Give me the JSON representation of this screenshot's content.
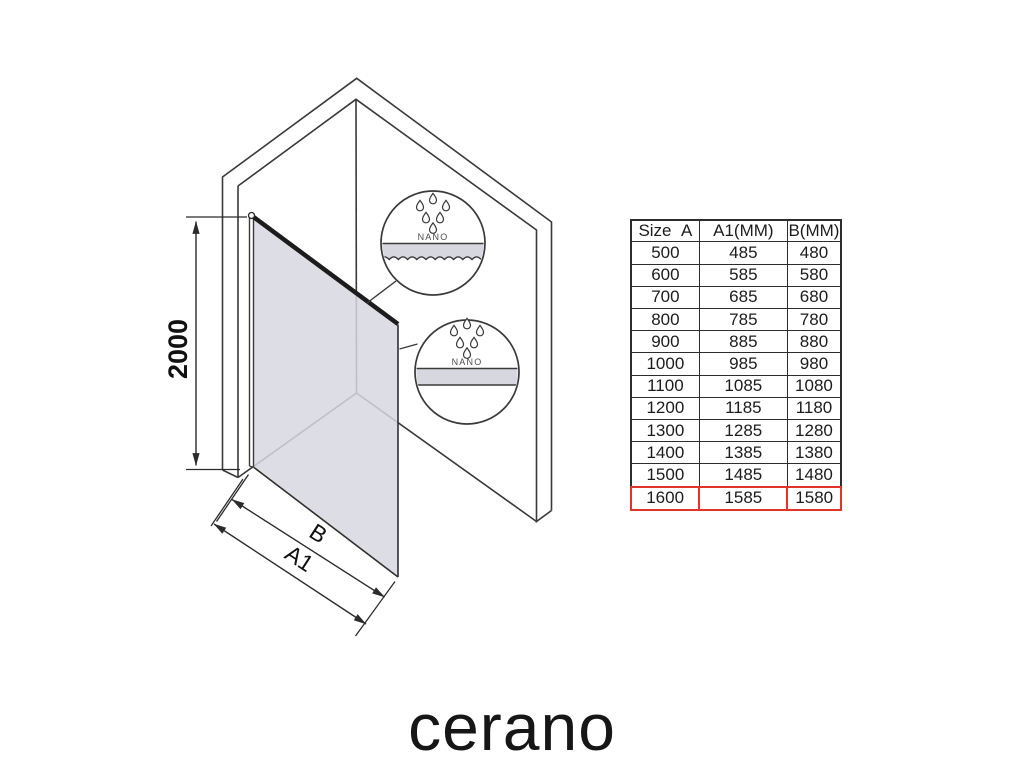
{
  "diagram": {
    "height_label": "2000",
    "width_label_outer": "B",
    "width_label_inner": "A1",
    "nano_label": "NANO",
    "glass_color": "#d7d7e0",
    "callout_count": 2,
    "drops_per_callout": 6
  },
  "table": {
    "headers": [
      "Size  A",
      "A1(MM)",
      "B(MM)"
    ],
    "rows": [
      [
        "500",
        "485",
        "480"
      ],
      [
        "600",
        "585",
        "580"
      ],
      [
        "700",
        "685",
        "680"
      ],
      [
        "800",
        "785",
        "780"
      ],
      [
        "900",
        "885",
        "880"
      ],
      [
        "1000",
        "985",
        "980"
      ],
      [
        "1100",
        "1085",
        "1080"
      ],
      [
        "1200",
        "1185",
        "1180"
      ],
      [
        "1300",
        "1285",
        "1280"
      ],
      [
        "1400",
        "1385",
        "1380"
      ],
      [
        "1500",
        "1485",
        "1480"
      ],
      [
        "1600",
        "1585",
        "1580"
      ]
    ],
    "highlight_row_index": 11,
    "highlight_color": "#e0352b"
  },
  "brand": {
    "logo_text": "cerano"
  }
}
